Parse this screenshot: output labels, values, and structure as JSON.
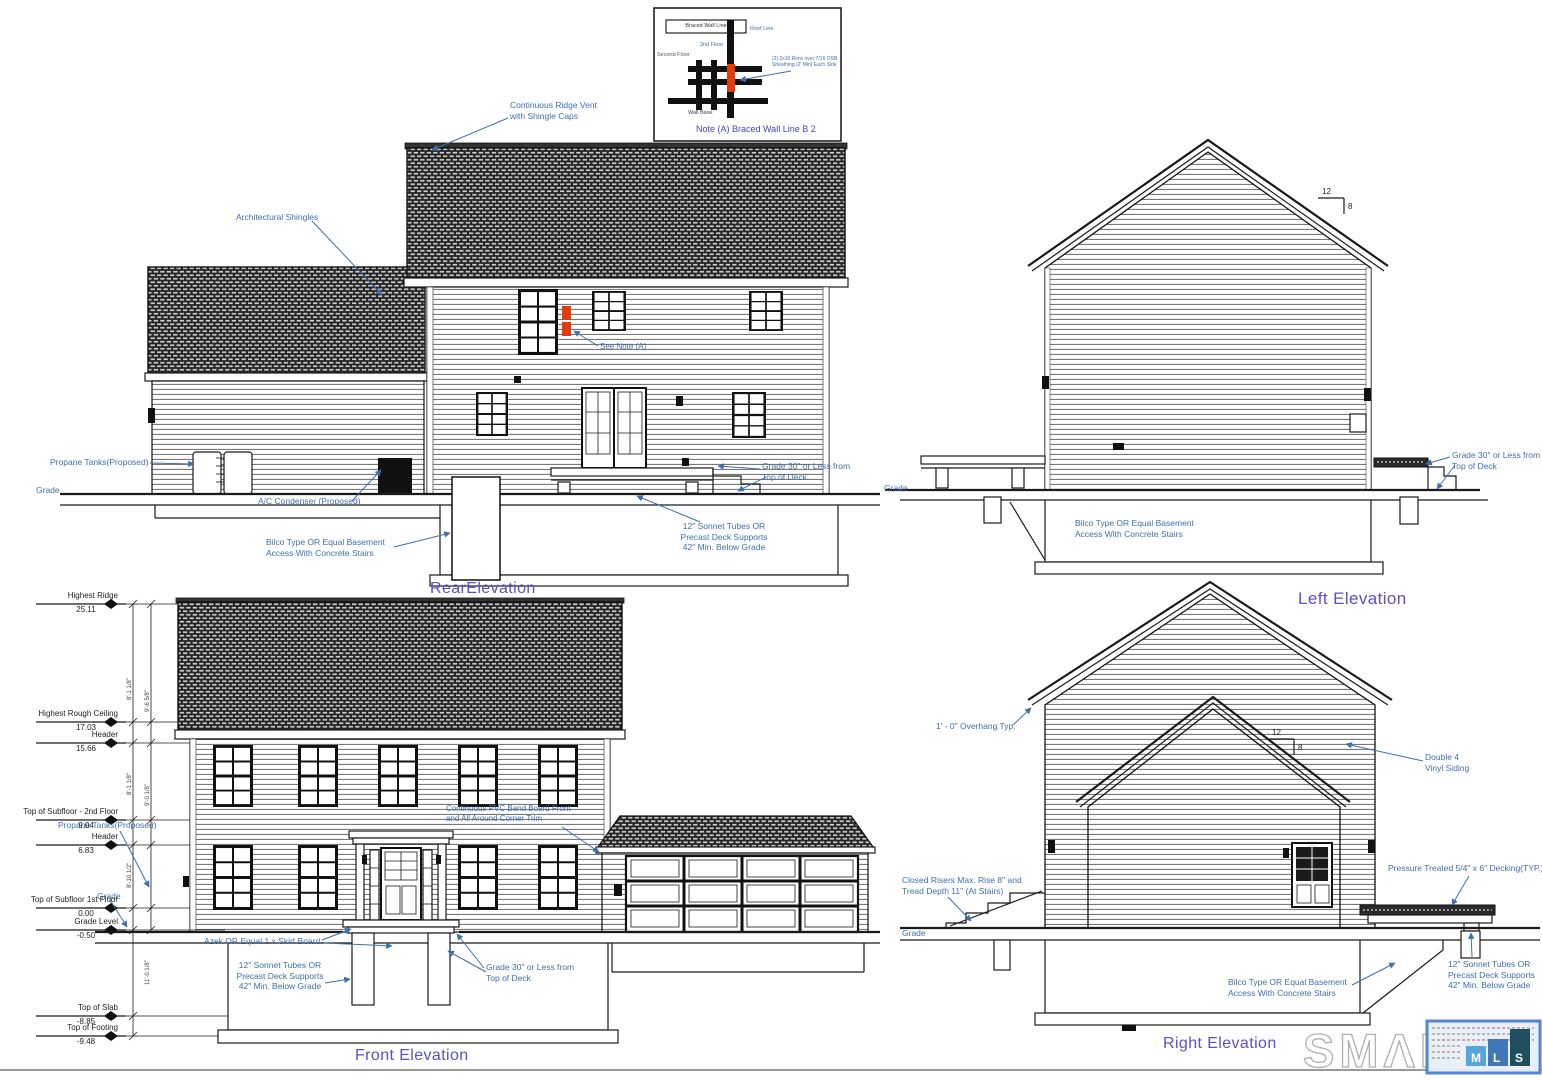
{
  "palette": {
    "annotation_blue": "#3f6fae",
    "title_purple": "#5b50c8",
    "line_black": "#1a1a1a",
    "highlight_red": "#e03c10",
    "mls_m_blue": "#56a7d8",
    "mls_l_blue": "#3f78b8",
    "mls_s_teal": "#1f4f5f"
  },
  "titles": {
    "rear": "RearElevation",
    "left": "Left Elevation",
    "front": "Front Elevation",
    "right": "Right Elevation"
  },
  "pitch": {
    "rise": "12",
    "run": "8"
  },
  "inset": {
    "caption": "Note (A) Braced Wall Line B 2",
    "box_label": "Braced Wall Line",
    "roof_line": "Roof Line",
    "floor_label": "2nd Floor",
    "second_floor": "Second Floor",
    "wall_base": "Wall Base",
    "note": "(2) 2x10 Rims over 7/16 OSB\nSheathing (2' Min) Each Side"
  },
  "annotations": {
    "ridge_vent": "Continuous Ridge Vent\nwith Shingle Caps",
    "arch_shingles": "Architectural Shingles",
    "see_note": "See Note (A)",
    "propane_rear": "Propane Tanks(Proposed)",
    "grade": "Grade",
    "ac_condenser": "A/C Condenser (Proposed)",
    "bilco": "Bilco Type OR Equal Basement\nAccess With Concrete Stairs",
    "grade30": "Grade 30\" or Less from\nTop of Deck",
    "sonotube": "12\" Sonnet Tubes OR\nPrecast Deck Supports\n42\" Min. Below Grade",
    "overhang": "1' - 0\" Overhang Typ.",
    "double4": "Double 4\nVinyl Siding",
    "closed_risers": "Closed Risers Max. Rise 8\" and\nTread Depth 11\" (At Stairs)",
    "pt_decking": "Pressure Treated 5/4\" x 6\" Decking(TYP.)",
    "azek": "Azek OR Equal 1 x Skirt Board",
    "pvc_band": "Continuous PVC Band Board Front\nand All Around Corner Trim",
    "propane_front": "Propane Tanks(Proposed)"
  },
  "front_markers": [
    {
      "label": "Highest Ridge",
      "value": "25.11"
    },
    {
      "label": "Highest Rough Ceiling",
      "value": "17.03"
    },
    {
      "label": "Header",
      "value": "15.66"
    },
    {
      "label": "Top of Subfloor - 2nd Floor",
      "value": "9.04"
    },
    {
      "label": "Header",
      "value": "6.83"
    },
    {
      "label": "Top of Subfloor 1st Floor",
      "value": "0.00"
    },
    {
      "label": "Grade Level",
      "value": "-0.50"
    },
    {
      "label": "Top of Slab",
      "value": "-8.85"
    },
    {
      "label": "Top of Footing",
      "value": "-9.48"
    }
  ],
  "dim_strings": [
    "8'-1 1/8\"",
    "9'-6 5/8\"",
    "8'-1 1/8\"",
    "9'-0 1/8\"",
    "8'-10 1/2\"",
    "11'-0 1/8\""
  ],
  "watermark": {
    "text": "SMΛRT",
    "mls": [
      "M",
      "L",
      "S"
    ]
  }
}
